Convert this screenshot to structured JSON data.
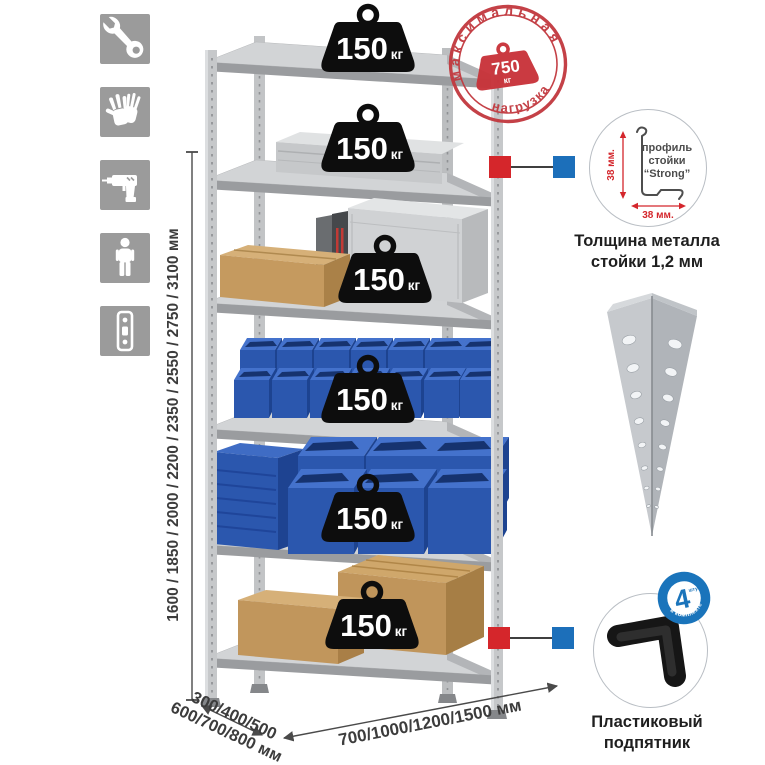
{
  "colors": {
    "tile_gray": "#9b9b9b",
    "metal_top": "#d2d4d6",
    "metal_edge": "#9a9c9f",
    "bin_blue": "#2b57ae",
    "cardboard": "#c59a5f",
    "badge_black": "#0d0d0d",
    "stamp_red": "#c23a40",
    "marker_red": "#d5262b",
    "marker_blue": "#1c6fba",
    "dim_text": "#3c3c3c",
    "detail_red": "#d4262c"
  },
  "left_icons": [
    {
      "name": "wrench-icon"
    },
    {
      "name": "gloves-icon"
    },
    {
      "name": "drill-icon"
    },
    {
      "name": "person-icon"
    },
    {
      "name": "rack-post-icon"
    }
  ],
  "rack": {
    "shelf_count": 6,
    "badges": [
      {
        "value": "150",
        "unit": "кг"
      },
      {
        "value": "150",
        "unit": "кг"
      },
      {
        "value": "150",
        "unit": "кг"
      },
      {
        "value": "150",
        "unit": "кг"
      },
      {
        "value": "150",
        "unit": "кг"
      },
      {
        "value": "150",
        "unit": "кг"
      }
    ]
  },
  "stamp": {
    "arc_top": "максимальная",
    "arc_bottom": "нагрузка",
    "value": "750",
    "unit": "кг"
  },
  "dimensions": {
    "height": "1600 / 1850 / 2000 / 2200 / 2350 / 2550 / 2750 / 3100 мм",
    "depth_line1": "300/400/500",
    "depth_line2": "600/700/800 мм",
    "width": "700/1000/1200/1500 мм"
  },
  "profile_detail": {
    "label_line1": "профиль",
    "label_line2": "стойки",
    "label_line3": "“Strong”",
    "dim_vertical": "38 мм.",
    "dim_horizontal": "38 мм.",
    "caption_line1": "Толщина металла",
    "caption_line2": "стойки 1,2 мм"
  },
  "foot_detail": {
    "badge_number": "4",
    "badge_small_text": "штуки",
    "badge_ring_text": "в комплекте",
    "caption_line1": "Пластиковый",
    "caption_line2": "подпятник"
  }
}
